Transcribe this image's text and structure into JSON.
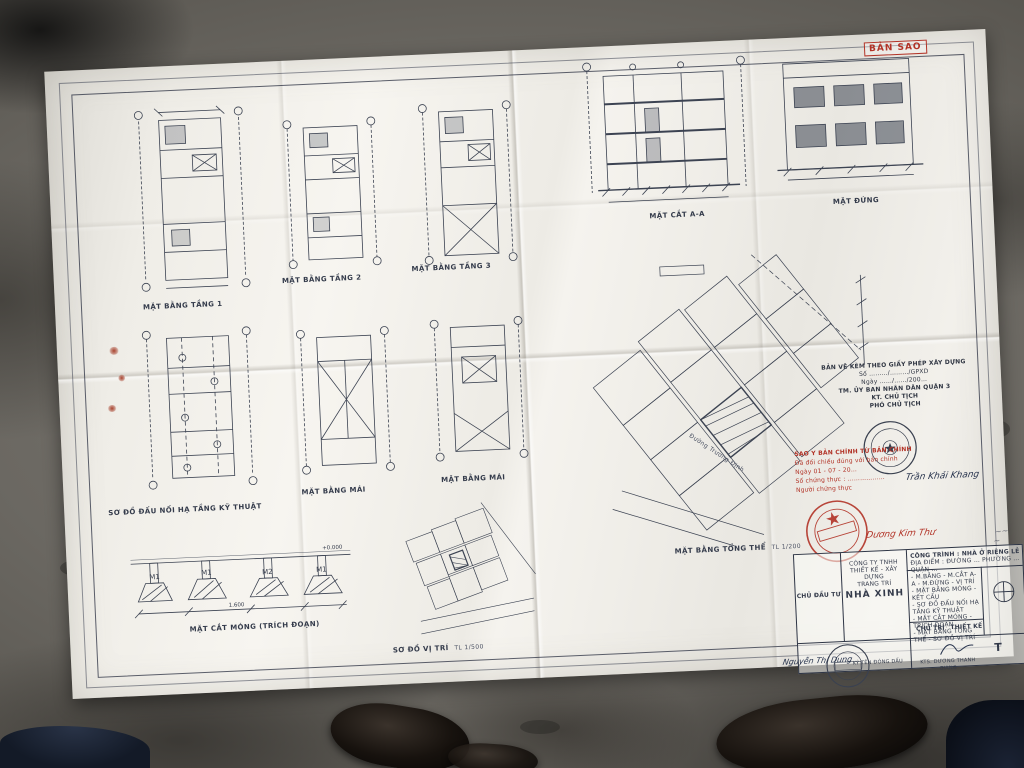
{
  "photo": {
    "description": "Folded architectural permit drawing on concrete floor",
    "paper_color": "#f4f2ed",
    "line_color": "#3c4352",
    "stamp_red": "#b23327"
  },
  "stamp_ban_sao": "BẢN SAO",
  "labels": {
    "floor1": "MẶT BẰNG TẦNG 1",
    "floor2": "MẶT BẰNG TẦNG 2",
    "floor3": "MẶT BẰNG TẦNG 3",
    "section": "MẶT CẮT A-A",
    "elevation": "MẶT ĐỨNG",
    "utility": "SƠ ĐỒ ĐẤU NỐI HẠ TẦNG KỸ THUẬT",
    "roof1": "MẶT BẰNG MÁI",
    "roof2": "MẶT BẰNG MÁI",
    "site": "MẶT BẰNG TỔNG THỂ",
    "site_scale": "TL 1/200",
    "foundation": "MẶT CẮT MÓNG (TRÍCH ĐOẠN)",
    "location": "SƠ ĐỒ VỊ TRÍ",
    "location_scale": "TL 1/500",
    "road": "Đường Trương Định"
  },
  "approval": {
    "l1": "BẢN VẼ KÈM THEO GIẤY PHÉP XÂY DỰNG",
    "l2": "Số ………/………/GPXD",
    "l3": "Ngày ……/……/200…",
    "l4": "TM. ỦY BAN NHÂN DÂN QUẬN 3",
    "l5": "KT. CHỦ TỊCH",
    "l6": "PHÓ CHỦ TỊCH"
  },
  "certification": {
    "r1": "SAO Y BẢN CHÍNH TỪ BẢN CHÍNH",
    "r2": "Đã đối chiếu đúng với bản chính",
    "r3": "Ngày  01 - 07 - 20…",
    "r4": "Số chứng thực : ………………",
    "r5": "Người chứng thực",
    "sig_black": "Trần Khải Khang",
    "sig_red": "Dương Kim Thư"
  },
  "foundation_marks": {
    "m1": "M1",
    "m2": "M1",
    "m3": "M2",
    "m4": "M1",
    "level": "+0.000",
    "dim": "1.600"
  },
  "titleblock": {
    "owner": "CHỦ ĐẦU TƯ",
    "company_l1": "CÔNG TY TNHH",
    "company_l2": "THIẾT KẾ - XÂY DỰNG",
    "company_l3": "TRANG TRÍ",
    "company_name": "NHÀ XINH",
    "project": "CÔNG TRÌNH : NHÀ Ở RIÊNG LẺ",
    "address": "ĐỊA ĐIỂM : ĐƯỜNG … PHƯỜNG … QUẬN …",
    "list1": "- M.BẰNG - M.CẮT A-A - M.ĐỨNG - VỊ TRÍ",
    "list2": "- MẶT BẰNG MÓNG - KẾT CẤU",
    "list3": "- SƠ ĐỒ ĐẤU NỐI HẠ TẦNG KỸ THUẬT",
    "list4": "- MẶT CẮT MÓNG - TRÍCH ĐOẠN",
    "list5": "- MẶT BẰNG TỔNG THỂ - SƠ ĐỒ VỊ TRÍ",
    "cell_lead": "CHỦ TRÌ",
    "cell_design": "THIẾT KẾ",
    "sign_label": "KÝ TÊN ĐÓNG DẤU",
    "architect": "KTS. DƯƠNG THANH GIANG",
    "partial_right": "T",
    "sig_hand": "Nguyễn Thị Dung"
  }
}
